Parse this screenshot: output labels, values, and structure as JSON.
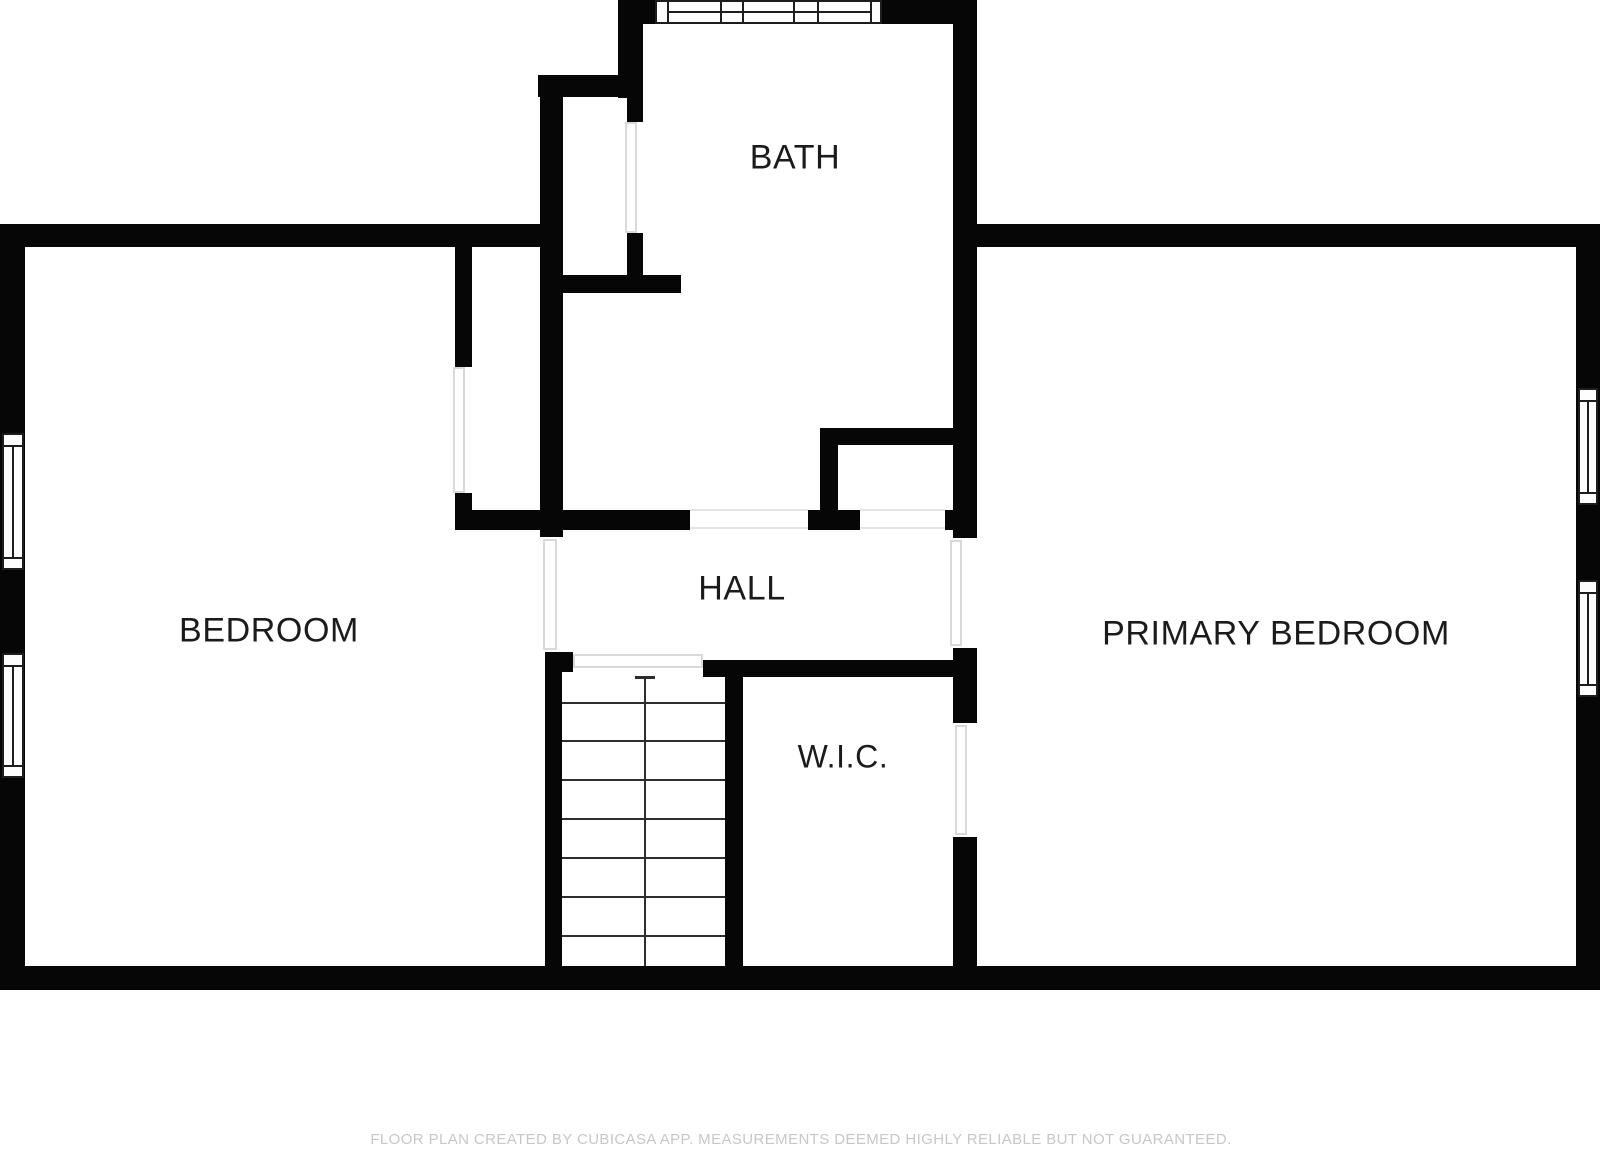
{
  "footer": {
    "text": "FLOOR PLAN CREATED BY CUBICASA APP. MEASUREMENTS DEEMED HIGHLY RELIABLE BUT NOT GUARANTEED."
  },
  "rooms": {
    "bath": {
      "label": "BATH"
    },
    "bedroom": {
      "label": "BEDROOM"
    },
    "hall": {
      "label": "HALL"
    },
    "primary_bedroom": {
      "label": "PRIMARY BEDROOM"
    },
    "wic": {
      "label": "W.I.C."
    }
  },
  "colors": {
    "wall": "#060606",
    "background": "#ffffff",
    "label_text": "#1b1b1b",
    "footer_text": "#c7c7c7",
    "opening_outline": "#d9d9d9",
    "window_frame": "#1d1d1d",
    "stair_line": "#2d2d2d",
    "hall_outline": "#e4e4e4"
  },
  "geometry": {
    "walls": [
      [
        0,
        224,
        25,
        764
      ],
      [
        0,
        966,
        1600,
        24
      ],
      [
        1576,
        224,
        24,
        766
      ],
      [
        0,
        224,
        557,
        23
      ],
      [
        973,
        224,
        627,
        23
      ],
      [
        618,
        0,
        25,
        98
      ],
      [
        643,
        0,
        14,
        24
      ],
      [
        880,
        0,
        97,
        24
      ],
      [
        953,
        0,
        24,
        538
      ],
      [
        538,
        75,
        105,
        22
      ],
      [
        540,
        75,
        23,
        462
      ],
      [
        627,
        97,
        16,
        25
      ],
      [
        627,
        233,
        16,
        60
      ],
      [
        545,
        275,
        136,
        18
      ],
      [
        455,
        247,
        17,
        120
      ],
      [
        455,
        493,
        17,
        37
      ],
      [
        457,
        510,
        233,
        20
      ],
      [
        808,
        510,
        52,
        20
      ],
      [
        945,
        510,
        32,
        20
      ],
      [
        838,
        428,
        117,
        17
      ],
      [
        820,
        428,
        18,
        82
      ],
      [
        545,
        652,
        28,
        20
      ],
      [
        703,
        660,
        272,
        17
      ],
      [
        953,
        648,
        24,
        75
      ],
      [
        953,
        837,
        24,
        151
      ],
      [
        545,
        652,
        17,
        314
      ],
      [
        725,
        660,
        18,
        306
      ]
    ],
    "openings": [
      [
        453,
        367,
        12,
        126
      ],
      [
        625,
        122,
        12,
        111
      ],
      [
        950,
        540,
        12,
        106
      ],
      [
        955,
        725,
        12,
        110
      ],
      [
        573,
        654,
        130,
        14
      ],
      [
        543,
        539,
        14,
        111
      ]
    ],
    "thin_lines": [
      [
        690,
        509,
        118,
        2
      ],
      [
        690,
        527,
        118,
        2
      ],
      [
        860,
        509,
        85,
        2
      ],
      [
        860,
        527,
        85,
        2
      ]
    ],
    "windows": [
      {
        "x": 655,
        "y": 0,
        "w": 227,
        "h": 24,
        "dir": "h",
        "caps": [
          667,
          870
        ],
        "mullions": [
          720,
          742,
          793,
          817
        ]
      },
      {
        "x": 2,
        "y": 433,
        "w": 22,
        "h": 137,
        "dir": "v",
        "caps": [
          445,
          557
        ],
        "mullions": []
      },
      {
        "x": 2,
        "y": 653,
        "w": 22,
        "h": 125,
        "dir": "v",
        "caps": [
          665,
          765
        ],
        "mullions": []
      },
      {
        "x": 1578,
        "y": 388,
        "w": 20,
        "h": 117,
        "dir": "v",
        "caps": [
          400,
          492
        ],
        "mullions": []
      },
      {
        "x": 1578,
        "y": 580,
        "w": 20,
        "h": 117,
        "dir": "v",
        "caps": [
          592,
          684
        ],
        "mullions": []
      }
    ],
    "stairs": {
      "x": 562,
      "y": 675,
      "w": 163,
      "h": 291,
      "treads": [
        702,
        740,
        779,
        818,
        857,
        896,
        935
      ],
      "center_x": 644,
      "marker_y": 677,
      "bottom_y": 966
    }
  }
}
